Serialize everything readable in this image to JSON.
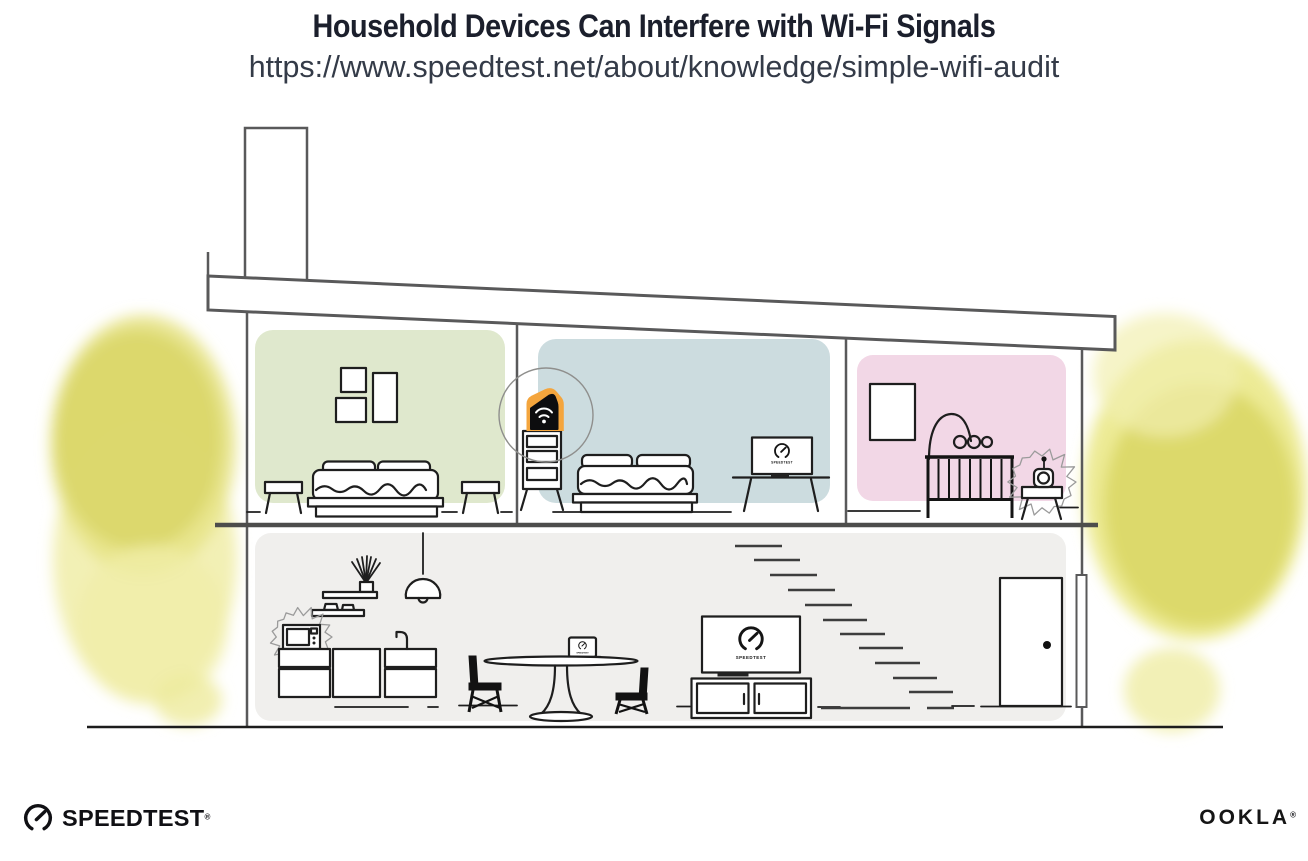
{
  "header": {
    "title": "Household Devices Can Interfere with Wi-Fi Signals",
    "url": "https://www.speedtest.net/about/knowledge/simple-wifi-audit"
  },
  "illustration": {
    "screen_label": "SPEEDTEST",
    "rooms": [
      "green-bedroom",
      "blue-bedroom",
      "pink-nursery",
      "main-floor"
    ],
    "device_icons": [
      "wifi-router-icon",
      "speedtest-gauge-icon",
      "tv-icon",
      "laptop-icon",
      "microwave-icon",
      "baby-monitor-icon"
    ],
    "interference_sources": [
      "microwave",
      "baby-monitor"
    ],
    "colors": {
      "accent_orange": "#F4A53D",
      "room_green": "#DFE8CD",
      "room_blue": "#CCDCDF",
      "room_pink": "#F2D7E6",
      "floor_gray": "#F0EFED",
      "foliage_yellow": "#DBD76B",
      "structure_line": "#59595A",
      "title_text": "#1B1F2C"
    }
  },
  "footer": {
    "speedtest_logo": "SPEEDTEST",
    "speedtest_mark": "®",
    "ookla_logo": "OOKLA",
    "ookla_mark": "®"
  }
}
